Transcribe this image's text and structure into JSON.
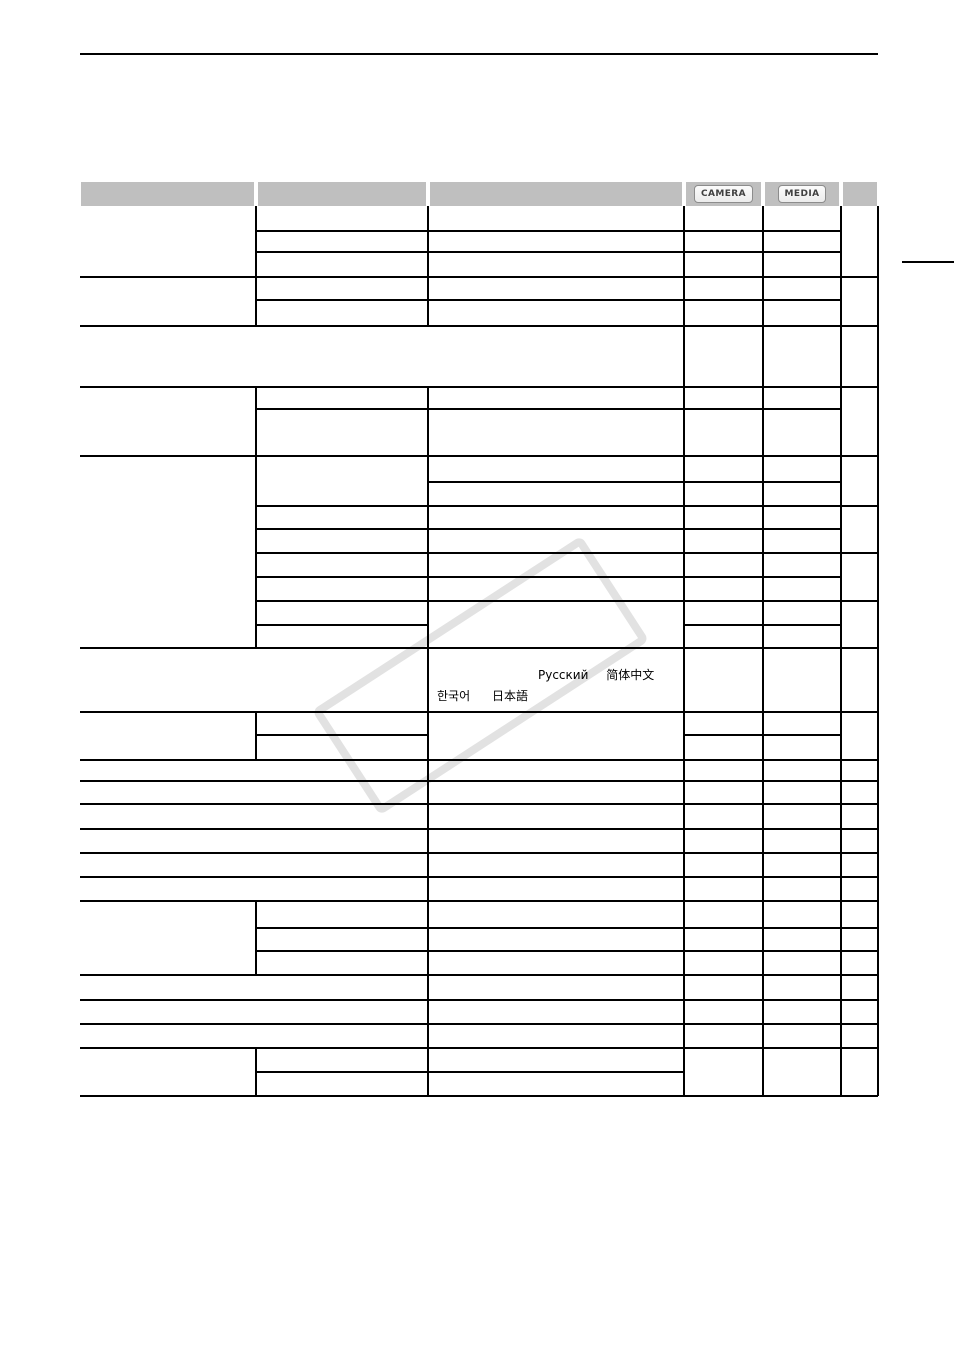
{
  "document": {
    "kind": "camcorder manual menu-options table page",
    "visible_text_note": "only badges and non-Latin language names rendered"
  },
  "table_header": {
    "camera_badge": "CAMERA",
    "media_badge": "MEDIA"
  },
  "languages": {
    "russian": "Русский",
    "chinese": "简体中文",
    "korean": "한국어",
    "japanese": "日本語"
  },
  "colors": {
    "header_band": "#bfbfbf",
    "grid_line": "#000000",
    "watermark": "#e2e2e2",
    "badge_border": "#8c8c8c",
    "badge_text": "#404040",
    "page_background": "#ffffff"
  }
}
